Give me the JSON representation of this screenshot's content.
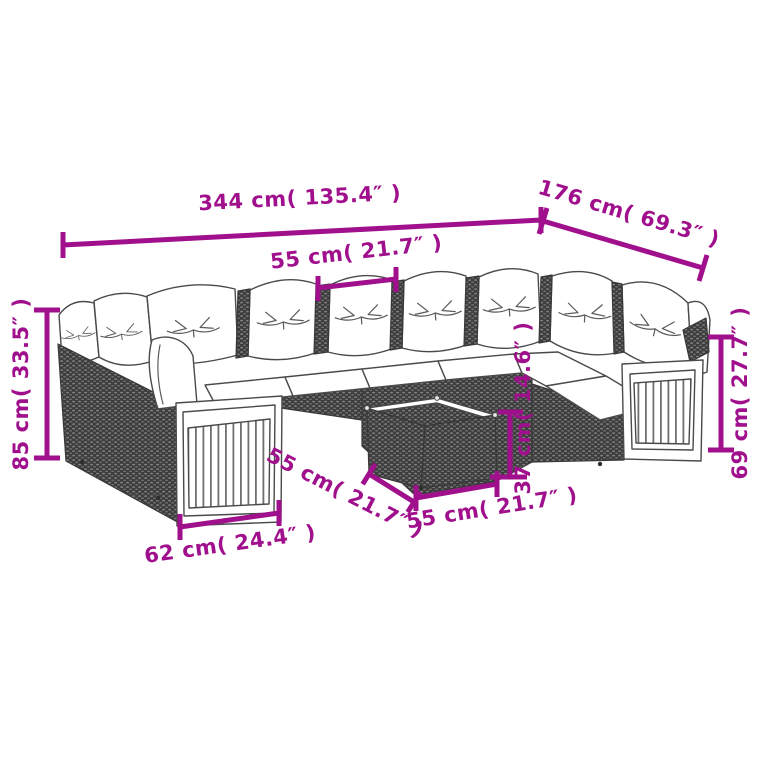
{
  "title": "Garden lounge set dimension diagram",
  "illustration": {
    "subject": "rattan garden sofa set with white cushions, acacia wood end panels and square coffee table",
    "style": "black-and-white line drawing with magenta dimension annotations"
  },
  "colors": {
    "dimension_accent": "#A0108C",
    "line_art": "#4a4a4a",
    "rattan_fill": "#3d3d3d",
    "cushion_fill": "#ffffff",
    "background": "#ffffff"
  },
  "dimensions": {
    "overall_width": {
      "label": "344 cm( 135.4″ )"
    },
    "overall_depth": {
      "label": "176 cm( 69.3″ )"
    },
    "seat_width": {
      "label": "55 cm( 21.7″ )"
    },
    "total_height": {
      "label": "85 cm( 33.5″ )"
    },
    "arm_height": {
      "label": "69 cm( 27.7″ )"
    },
    "end_panel_width": {
      "label": "62 cm( 24.4″ )"
    },
    "seat_depth": {
      "label": "55 cm( 21.7″ )"
    },
    "table_width": {
      "label": "55 cm( 21.7″ )"
    },
    "table_height": {
      "label": "37 cm( 14.6″ )"
    }
  }
}
